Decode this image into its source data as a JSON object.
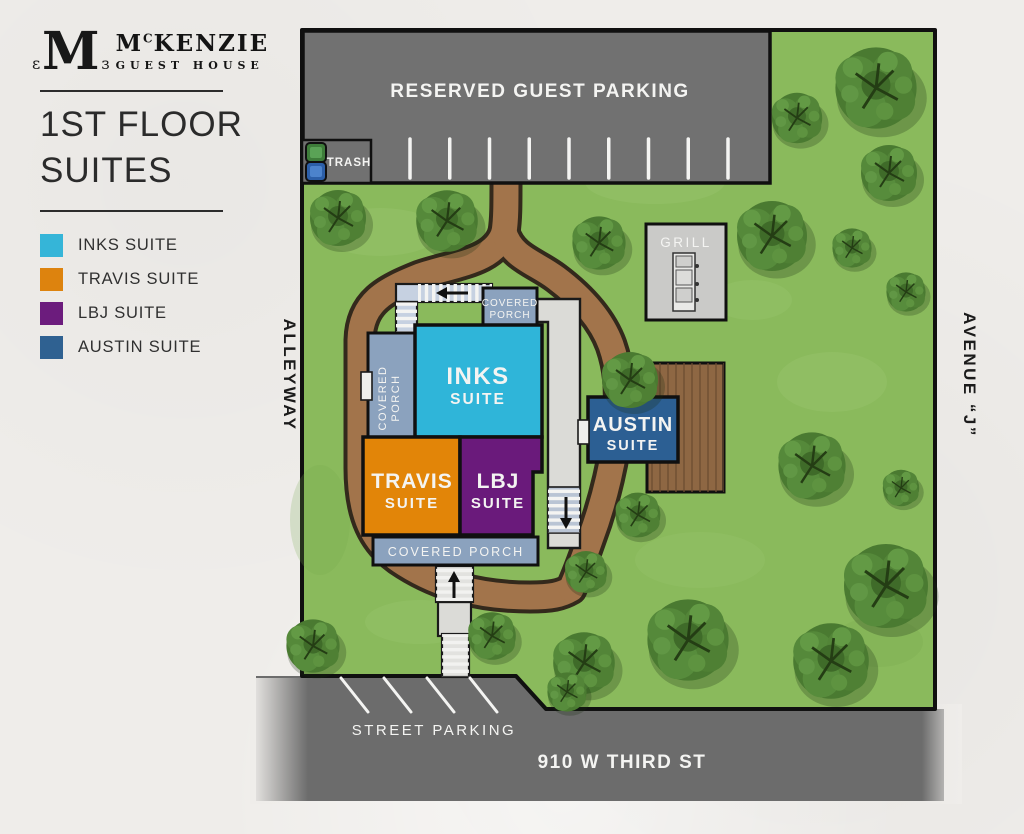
{
  "sidebar": {
    "logo": {
      "monogram": "M",
      "brand_prefix": "M",
      "brand_sup": "C",
      "brand_name": "KENZIE",
      "brand_sub": "GUEST HOUSE"
    },
    "title_line1": "1ST FLOOR",
    "title_line2": "SUITES",
    "legend": [
      {
        "label": "INKS SUITE",
        "color": "#35b5d8"
      },
      {
        "label": "TRAVIS SUITE",
        "color": "#dd830e"
      },
      {
        "label": "LBJ SUITE",
        "color": "#6c1c7d"
      },
      {
        "label": "AUSTIN SUITE",
        "color": "#2f6191"
      }
    ]
  },
  "map": {
    "labels": {
      "reserved_parking": "RESERVED GUEST PARKING",
      "trash": "TRASH",
      "grill": "GRILL",
      "alleyway": "ALLEYWAY",
      "avenue": "AVENUE “J”",
      "street_parking": "STREET PARKING",
      "street_name": "910 W THIRD ST",
      "covered_line1": "COVERED",
      "covered_line2": "PORCH",
      "covered_porch": "COVERED PORCH"
    },
    "suites": {
      "inks": {
        "name": "INKS",
        "type": "SUITE",
        "color": "#2fb5d9"
      },
      "travis": {
        "name": "TRAVIS",
        "type": "SUITE",
        "color": "#e28508"
      },
      "lbj": {
        "name": "LBJ",
        "type": "SUITE",
        "color": "#6a1a7b"
      },
      "austin": {
        "name": "AUSTIN",
        "type": "SUITE",
        "color": "#2c5f93"
      }
    },
    "colors": {
      "grass": "#8aba5c",
      "path": "#a2744b",
      "path_edge": "#33291c",
      "road": "#6c6c6c",
      "parking_lot": "#717171",
      "porch": "#8ba2be",
      "concrete": "#dbdbd7",
      "stairs": "#c6d1e1",
      "deck": "#8e6743",
      "grill_pad": "#cacac8"
    },
    "guest_parking_stall_count": 9,
    "street_parking_stall_count": 4,
    "trees": [
      [
        338,
        218,
        1.0
      ],
      [
        447,
        221,
        1.1
      ],
      [
        599,
        243,
        0.95
      ],
      [
        772,
        236,
        1.25
      ],
      [
        876,
        88,
        1.45
      ],
      [
        797,
        118,
        0.9
      ],
      [
        889,
        173,
        1.0
      ],
      [
        852,
        248,
        0.7
      ],
      [
        906,
        292,
        0.7
      ],
      [
        630,
        380,
        1.0
      ],
      [
        812,
        466,
        1.2
      ],
      [
        901,
        488,
        0.65
      ],
      [
        886,
        586,
        1.5
      ],
      [
        831,
        661,
        1.35
      ],
      [
        688,
        640,
        1.45
      ],
      [
        638,
        515,
        0.8
      ],
      [
        586,
        572,
        0.75
      ],
      [
        584,
        663,
        1.1
      ],
      [
        492,
        636,
        0.85
      ],
      [
        313,
        646,
        0.95
      ],
      [
        567,
        692,
        0.7
      ]
    ]
  }
}
